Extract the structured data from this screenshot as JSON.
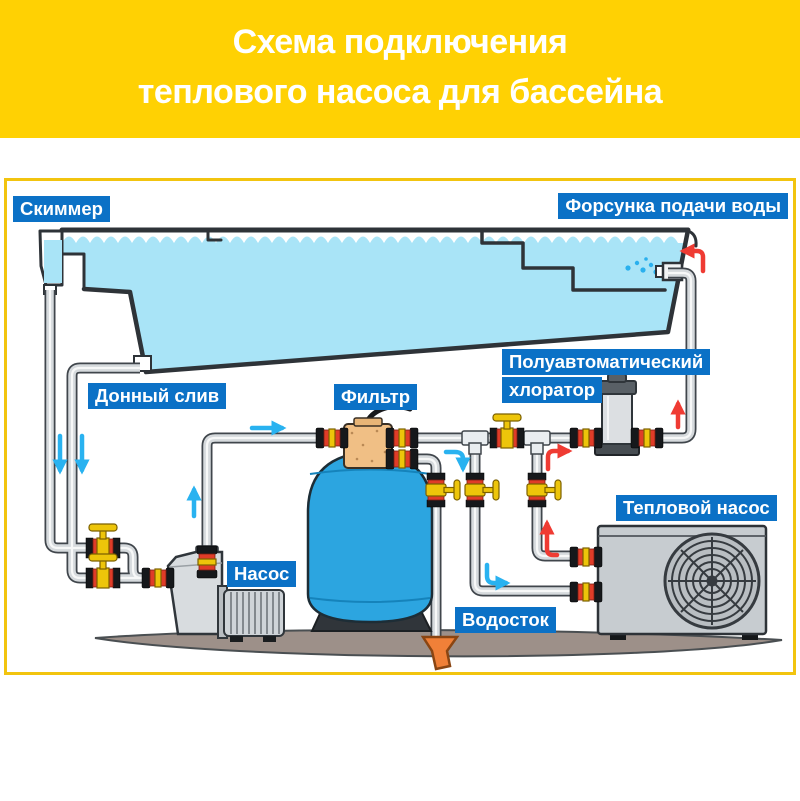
{
  "banner": {
    "title_line1": "Схема подключения",
    "title_line2": "теплового насоса для бассейна"
  },
  "diagram": {
    "labels": {
      "skimmer": "Скиммер",
      "water_inlet_nozzle": "Форсунка подачи воды",
      "bottom_drain": "Донный слив",
      "filter": "Фильтр",
      "chlorinator_line1": "Полуавтоматический",
      "chlorinator_line2": "хлоратор",
      "pump": "Насос",
      "heat_pump": "Тепловой насос",
      "drain": "Водосток"
    }
  },
  "colors": {
    "banner_bg": "#FFD103",
    "frame_border": "#F2C40F",
    "label_bg": "#0B71C6",
    "label_text": "#FFFFFF",
    "pool_water": "#A9E4F7",
    "filter_tank": "#2CA5E0",
    "pipe": "#D6DADD",
    "pipe_outline": "#40464C",
    "valve_yellow": "#EDC50A",
    "union_red": "#E03C28",
    "ground": "#9D9089",
    "equipment_gray": "#C7CCD0",
    "drain_funnel": "#F08038",
    "cold_water_arrow": "#29B2F0",
    "hot_water_arrow": "#EF3B33"
  }
}
